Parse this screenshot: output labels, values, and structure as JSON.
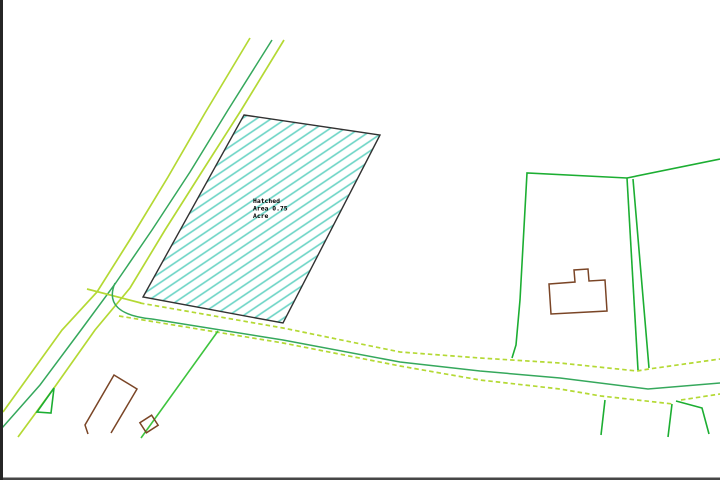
{
  "canvas": {
    "background": "#ffffff"
  },
  "hatched_parcel": {
    "label_lines": [
      "Hatched",
      "Area 0.75",
      "Acre"
    ],
    "area_value": "0.75",
    "area_unit": "Acre"
  },
  "colors": {
    "road_edge": "#b4d934",
    "road_center": "#35a85c",
    "boundary_green": "#1cae32",
    "branch_green": "#3ec43e",
    "building_brown": "#7a4526",
    "hatch_fill_line": "#72d6c8",
    "parcel_outline": "#323232",
    "border_black": "#262626",
    "label_text": "#000000"
  }
}
